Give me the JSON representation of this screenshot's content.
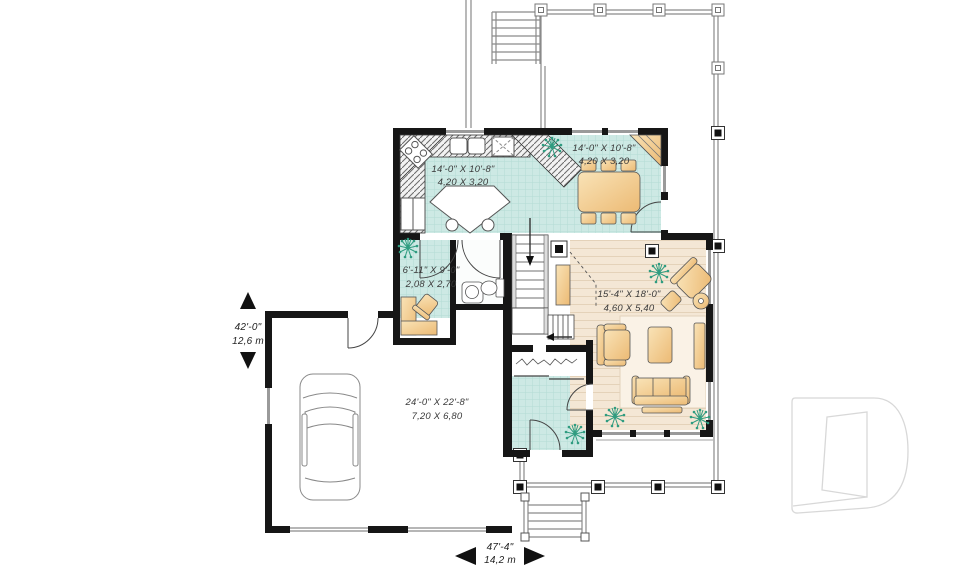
{
  "plan": {
    "title": "first-floor-plan",
    "rooms": {
      "kitchen": {
        "imperial": "14'-0\" X 10'-8\"",
        "metric": "4,20 X 3,20"
      },
      "dining": {
        "imperial": "14'-0\" X 10'-8\"",
        "metric": "4,20 X 3,20"
      },
      "office": {
        "imperial": "6'-11\" X 9'-0\"",
        "metric": "2,08 X 2,70"
      },
      "living": {
        "imperial": "15'-4\" X 18'-0\"",
        "metric": "4,60 X 5,40"
      },
      "garage": {
        "imperial": "24'-0\" X 22'-8\"",
        "metric": "7,20 X 6,80"
      }
    },
    "overall": {
      "depth": {
        "imperial": "42'-0\"",
        "metric": "12,6 m"
      },
      "width": {
        "imperial": "47'-4\"",
        "metric": "14,2 m"
      }
    },
    "logo": {
      "letter": "D"
    },
    "colors": {
      "wall": "#161616",
      "tile": "#cde9e4",
      "wood": "#f4e7d5",
      "furniture": "#f3cf95",
      "plant": "#2f9c80",
      "porch_line": "#8a8a8a",
      "logo_outline": "#d8d8d8"
    }
  }
}
